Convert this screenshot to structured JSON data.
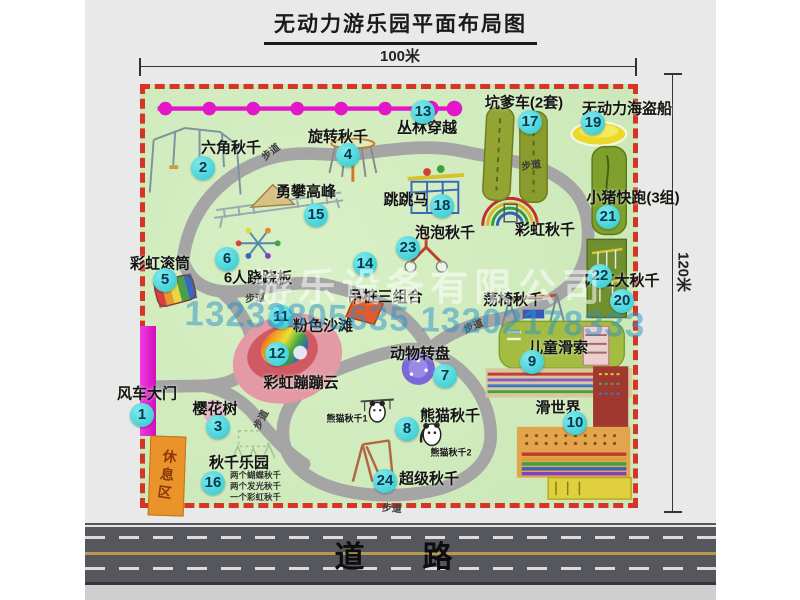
{
  "title": "无动力游乐园平面布局图",
  "dimensions": {
    "horizontal": "100米",
    "vertical": "120米"
  },
  "watermark": {
    "company": "游乐设备有限公司",
    "phone": "13233805635 13202178333"
  },
  "road_label": "道　路",
  "trail_label": "步道",
  "rest_area_label": "休息区",
  "pois": [
    {
      "num": "1",
      "label": "风车大门"
    },
    {
      "num": "2",
      "label": "六角秋千"
    },
    {
      "num": "3",
      "label": "樱花树"
    },
    {
      "num": "4",
      "label": "旋转秋千"
    },
    {
      "num": "5",
      "label": "彩虹滚筒"
    },
    {
      "num": "6",
      "label": "6人跷跷板"
    },
    {
      "num": "7",
      "label": "动物转盘"
    },
    {
      "num": "8",
      "label": "熊猫秋千"
    },
    {
      "num": "9",
      "label": "儿童滑索"
    },
    {
      "num": "10",
      "label": "滑世界"
    },
    {
      "num": "11",
      "label": "粉色沙滩"
    },
    {
      "num": "12",
      "label": "彩虹蹦蹦云"
    },
    {
      "num": "13",
      "label": "丛林穿越"
    },
    {
      "num": "14",
      "label": "吊桩三组合"
    },
    {
      "num": "15",
      "label": "勇攀高峰"
    },
    {
      "num": "16",
      "label": "秋千乐园"
    },
    {
      "num": "17",
      "label": "坑爹车(2套)"
    },
    {
      "num": "18",
      "label": "跳跳马"
    },
    {
      "num": "19",
      "label": "无动力海盗船"
    },
    {
      "num": "20",
      "label": "网红大秋千"
    },
    {
      "num": "21",
      "label": "小猪快跑(3组)"
    },
    {
      "num": "22",
      "label": "荡椅秋千"
    },
    {
      "num": "23",
      "label": "泡泡秋千"
    },
    {
      "num": "24",
      "label": "超级秋千"
    }
  ],
  "extra_labels": {
    "rainbow_swing": "彩虹秋千",
    "panda_swing_1": "熊猫秋千1",
    "panda_swing_2": "熊猫秋千2",
    "swing_park_details": [
      "两个蝴蝶秋千",
      "两个发光秋千",
      "一个彩虹秋千"
    ]
  },
  "colors": {
    "border_red": "#d63426",
    "map_green": "#cde9bb",
    "badge_cyan": "#2cc9cf",
    "zipline_magenta": "#e316c9",
    "gate_magenta": "#e020d0",
    "rest_area_orange": "#e9932a",
    "road_gray": "#56575d"
  }
}
